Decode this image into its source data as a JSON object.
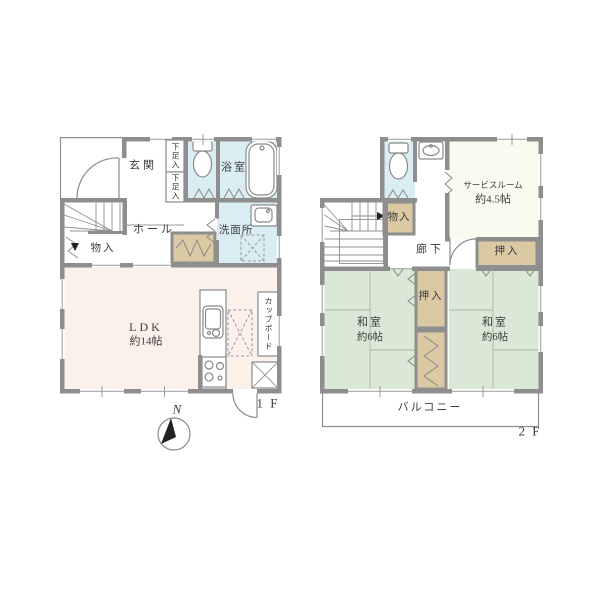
{
  "colors": {
    "wall_gray": "#8e8e8e",
    "water_room_blue": "#d9edf3",
    "ldk_pink": "#fbf0ea",
    "tatami_green": "#d9e9d5",
    "closet_tan": "#dbc9a4",
    "service_room_cream": "#fbfaee",
    "label_text": "#3c3c3c"
  },
  "floor1": {
    "floor_label": "1 F",
    "compass_label": "N",
    "rooms": {
      "genkan": "玄関",
      "shoe_box_upper": "下足入",
      "shoe_box_lower": "下足入",
      "bathroom": "浴室",
      "washroom": "洗面所",
      "hall": "ホール",
      "storage": "物入",
      "ldk_name": "LDK",
      "ldk_size": "約14帖",
      "cupboard": "カップボード"
    }
  },
  "floor2": {
    "floor_label": "2 F",
    "rooms": {
      "service_name": "サービスルーム",
      "service_size": "約4.5帖",
      "storage": "物入",
      "corridor": "廊下",
      "closet_right": "押入",
      "closet_center": "押入",
      "washitsu_left_name": "和室",
      "washitsu_left_size": "約6帖",
      "washitsu_right_name": "和室",
      "washitsu_right_size": "約6帖",
      "balcony": "バルコニー"
    }
  }
}
